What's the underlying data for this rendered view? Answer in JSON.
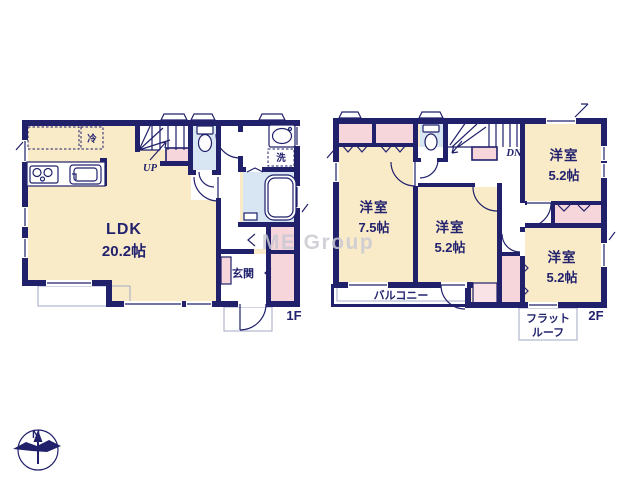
{
  "watermark_text": "ME Group",
  "compass": {
    "north_label": "N"
  },
  "floor1": {
    "floor_label": "1F",
    "ldk_name": "LDK",
    "ldk_size": "20.2帖",
    "stairs_label": "UP",
    "refrigerator_label": "冷",
    "laundry_label": "洗",
    "entrance_label": "玄関"
  },
  "floor2": {
    "floor_label": "2F",
    "stairs_label": "DN",
    "room_left": {
      "name": "洋室",
      "size": "7.5帖"
    },
    "room_middle": {
      "name": "洋室",
      "size": "5.2帖"
    },
    "room_top_right": {
      "name": "洋室",
      "size": "5.2帖"
    },
    "room_bottom_right": {
      "name": "洋室",
      "size": "5.2帖"
    },
    "balcony_label": "バルコニー",
    "flat_roof_line1": "フラット",
    "flat_roof_line2": "ルーフ"
  },
  "colors": {
    "wall": "#20206B",
    "room_fill": "#FAEBC8",
    "closet_fill": "#F7D6DB",
    "wet_area_fill": "#D8E5F2",
    "label_text": "#22226E",
    "watermark": "#C9C9D2"
  }
}
